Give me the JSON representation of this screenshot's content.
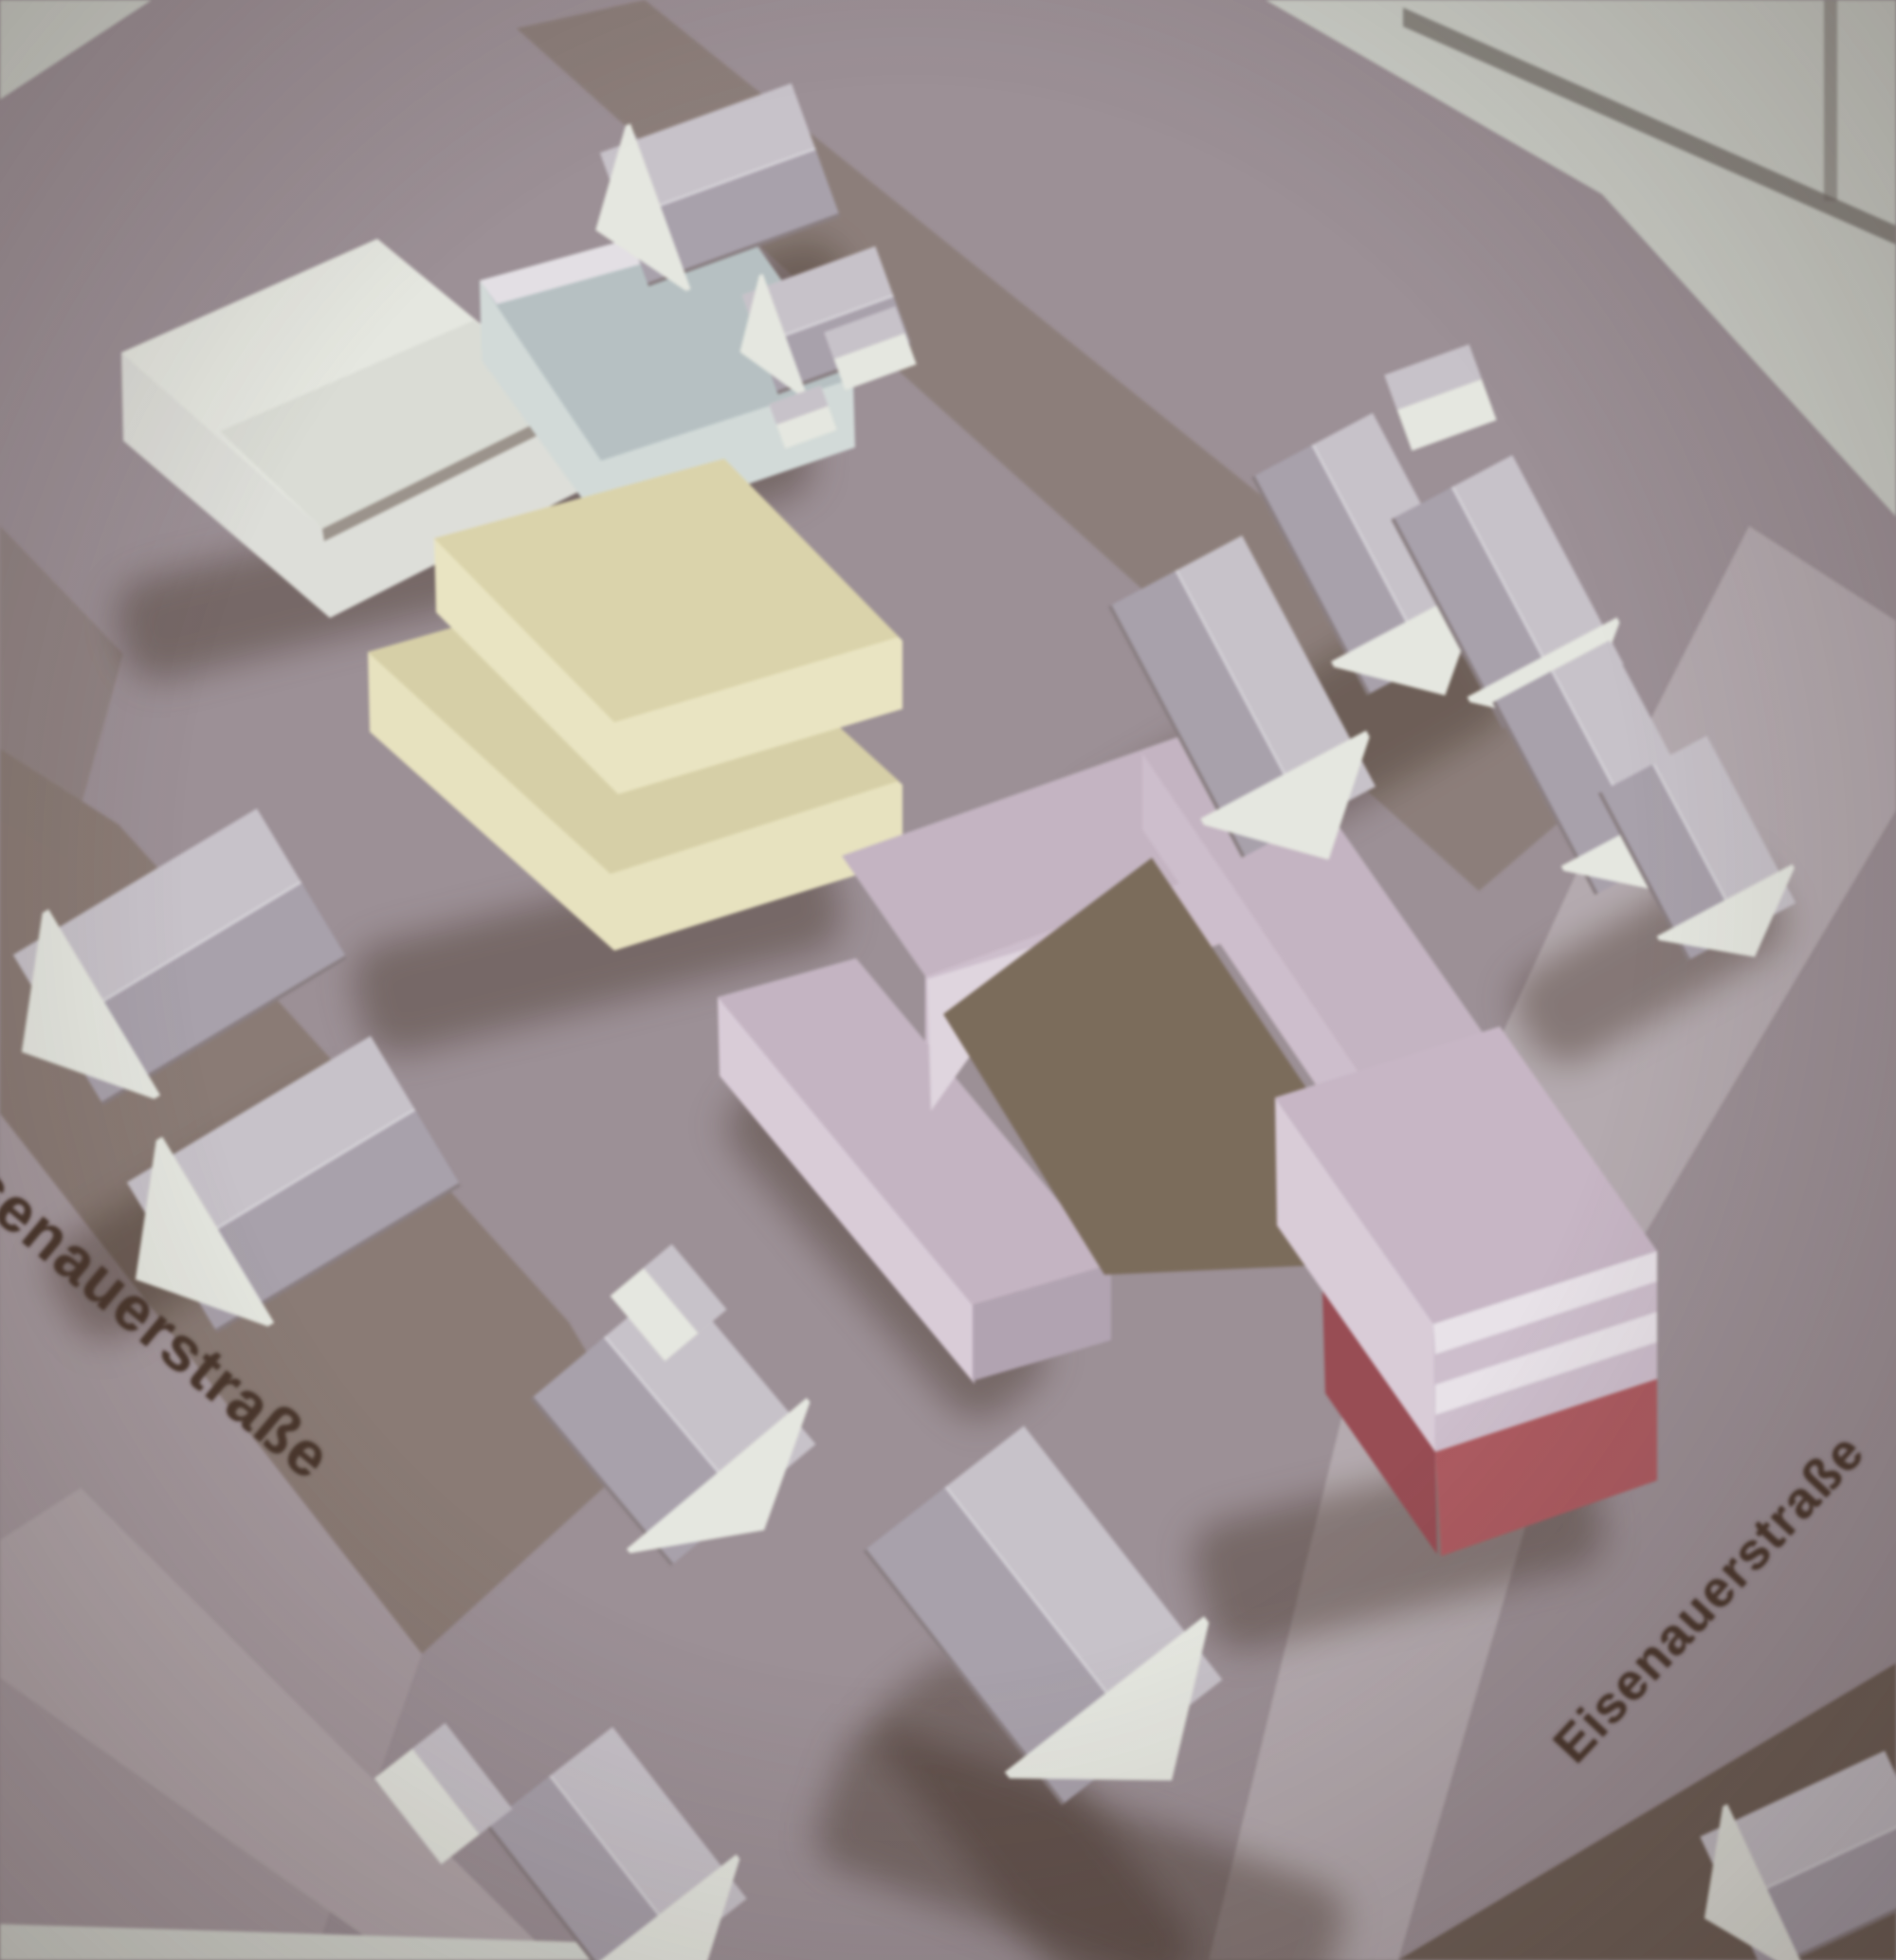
{
  "street_labels": {
    "left_partial": "isenauerstraße",
    "right": "Eisenauerstraße"
  },
  "colors": {
    "ground": "#9c9096",
    "ground_light": "#a89aa0",
    "street_dark": "#8b7b74",
    "street_light": "#b6abb0",
    "lightband": "#b4a8ac",
    "paper": "#cdd1c9",
    "paper_line": "#6f6862",
    "white_face": "#e7e9e1",
    "white_sil": "#dfe0da",
    "white_roof_light": "#c9c3cb",
    "white_roof_dark": "#a9a1ad",
    "blue_roof": "#b6c2c4",
    "blue_face": "#d3dcda",
    "yellow_roof": "#d9d1a4",
    "yellow_face": "#eae4bd",
    "pink_roof": "#c6b5c4",
    "pink_face": "#d0bfce",
    "pink_face_light": "#dccdda",
    "pink_face_dark": "#b3a3b3",
    "pink_notch": "#e2d6e0",
    "band_white": "#eae4ea",
    "red": "#b4595f",
    "red_dark": "#9e4a52",
    "courtyard": "#7c6b59",
    "shadow": "rgba(66,47,36,0.42)",
    "tree_white": "#e3e6e1",
    "tree_dark": "#564233",
    "tree_brown": "#8d7b6c",
    "text_brown": "#4a352a",
    "dark_corner": "#6e5d53",
    "bottom_white": "#d8dbd3"
  }
}
